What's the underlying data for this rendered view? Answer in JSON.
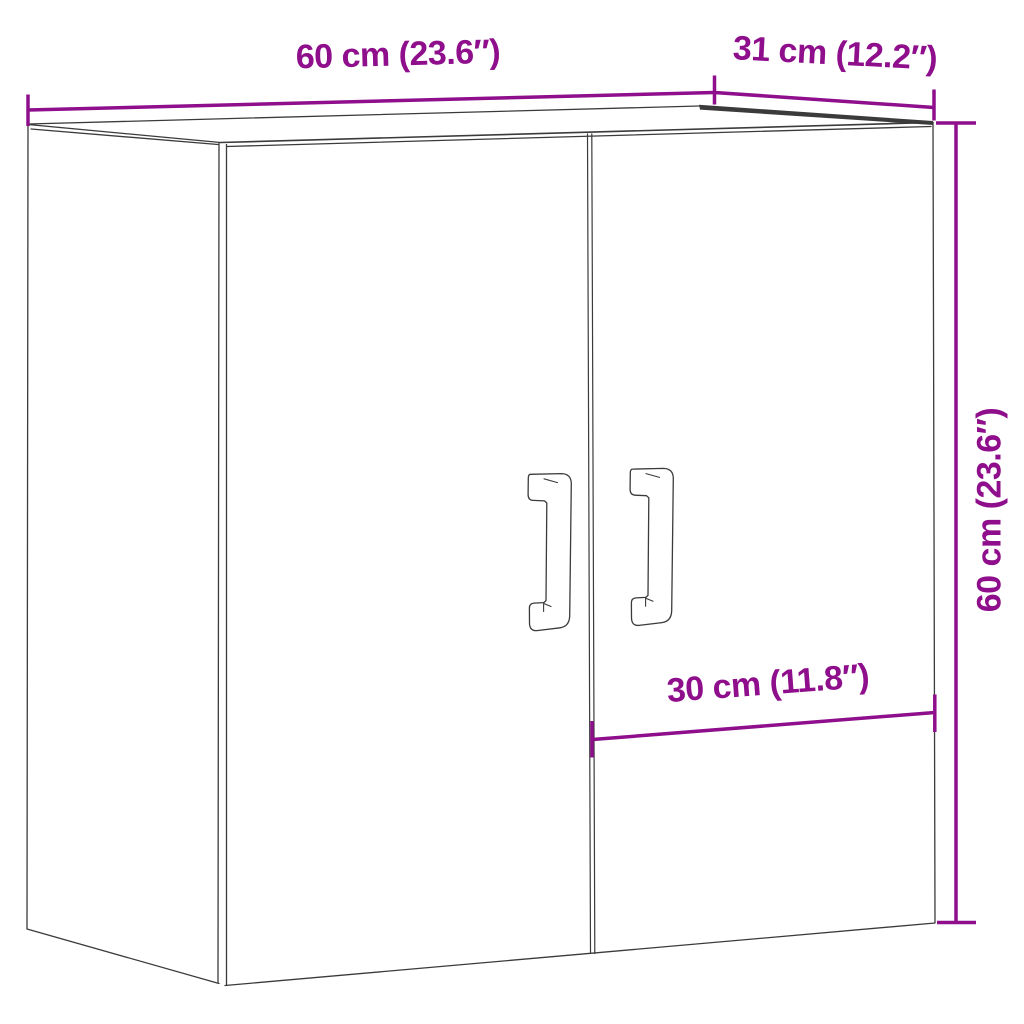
{
  "diagram": {
    "background": "#FFFFFF",
    "colors": {
      "dimension_accent": "#8E0E8C",
      "line_art": "#3B3B3B"
    },
    "labels": {
      "width_top": "60 cm (23.6″)",
      "depth_top": "31 cm (12.2″)",
      "height_right": "60 cm (23.6″)",
      "door_width": "30 cm (11.8″)"
    }
  }
}
